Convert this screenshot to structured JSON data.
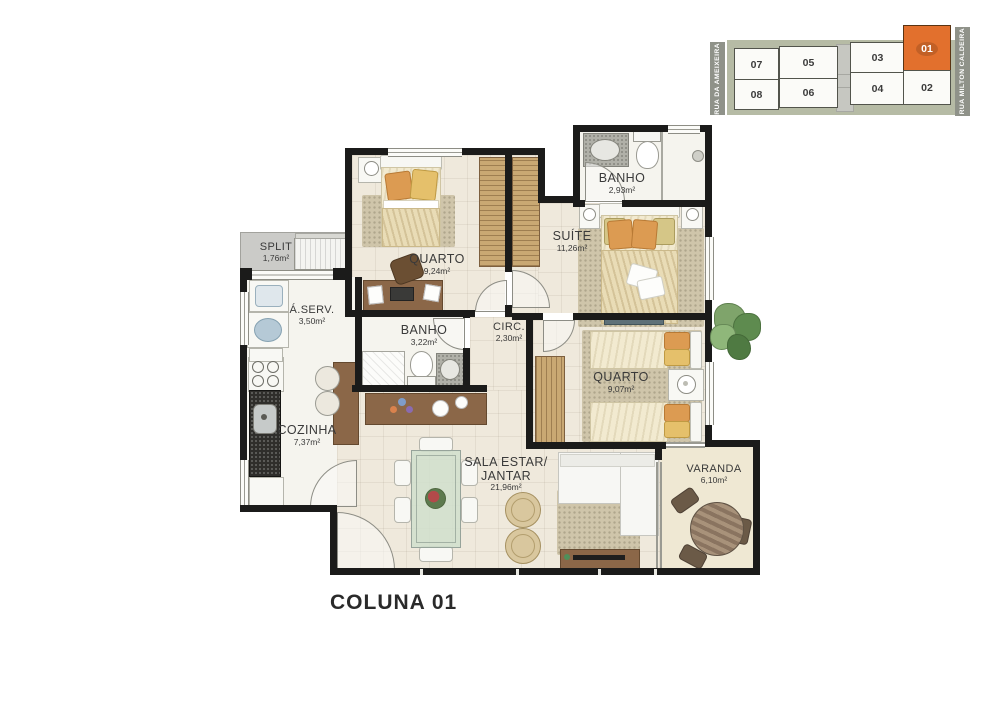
{
  "title": "COLUNA 01",
  "key_plan": {
    "street_left": "RUA DA AMEIXEIRA",
    "street_right": "RUA MILTON CALDEIRA",
    "units_top": [
      "07",
      "05",
      "03",
      "01"
    ],
    "units_bottom": [
      "08",
      "06",
      "04",
      "02"
    ],
    "highlighted_unit": "01",
    "highlight_color": "#e2702d",
    "body_color": "#b6bba5",
    "street_bar_color": "#8f9289"
  },
  "rooms": {
    "quarto1": {
      "name": "QUARTO",
      "area": "9,24m²"
    },
    "banho_suite": {
      "name": "BANHO",
      "area": "2,93m²"
    },
    "suite": {
      "name": "SUÍTE",
      "area": "11,26m²"
    },
    "split": {
      "name": "SPLIT",
      "area": "1,76m²"
    },
    "area_servico": {
      "name": "Á.SERV.",
      "area": "3,50m²"
    },
    "banho_social": {
      "name": "BANHO",
      "area": "3,22m²"
    },
    "circulacao": {
      "name": "CIRC.",
      "area": "2,30m²"
    },
    "cozinha": {
      "name": "COZINHA",
      "area": "7,37m²"
    },
    "quarto2": {
      "name": "QUARTO",
      "area": "9,07m²"
    },
    "sala": {
      "name_line1": "SALA ESTAR/",
      "name_line2": "JANTAR",
      "area": "21,96m²"
    },
    "varanda": {
      "name": "VARANDA",
      "area": "6,10m²"
    }
  },
  "colors": {
    "wall": "#1b1b1a",
    "floor": "#efe9dc",
    "rug": "#cfc5aa",
    "wood": "#8b6748",
    "wardrobe": "#c9a873"
  }
}
